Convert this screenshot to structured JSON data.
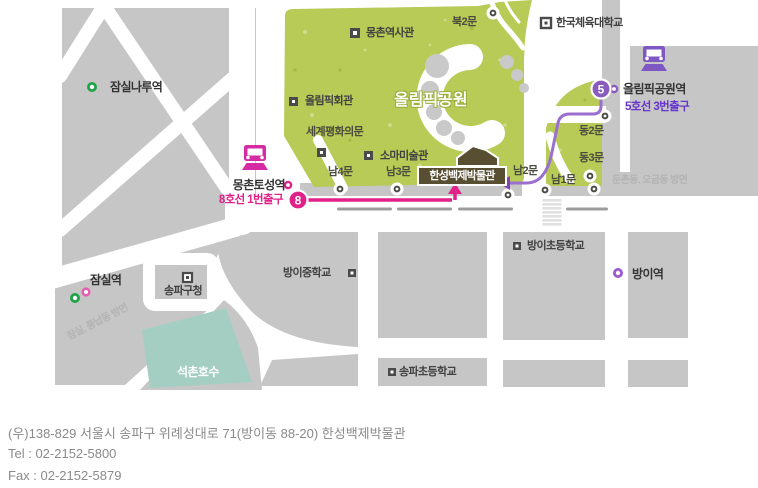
{
  "map": {
    "park": {
      "name": "올림픽공원"
    },
    "places": {
      "mongchon_history_hall": "몽촌역사관",
      "north_gate2": "북2문",
      "korea_national_sport_univ": "한국체육대학교",
      "olympic_hall": "올림픽회관",
      "world_peace_gate": "세계평화의문",
      "soma_museum": "소마미술관",
      "south_gate4": "남4문",
      "south_gate3": "남3문",
      "south_gate2": "남2문",
      "south_gate1": "남1문",
      "east_gate2": "동2문",
      "east_gate3": "동3문",
      "hanseong_baekje_museum": "한성백제박물관",
      "bangi_middle_school": "방이중학교",
      "bangi_elementary_school": "방이초등학교",
      "songpa_elementary_school": "송파초등학교",
      "songpa_gu_office": "송파구청",
      "seokchon_lake": "석촌호수"
    },
    "stations": {
      "jamsilnaru": {
        "name": "잠실나루역"
      },
      "jamsil": {
        "name": "잠실역"
      },
      "bangi": {
        "name": "방이역"
      },
      "mongchontoseong": {
        "name": "몽촌토성역",
        "exit": "8호선 1번출구",
        "line_number": "8"
      },
      "olympic_park": {
        "name": "올림픽공원역",
        "exit": "5호선 3번출구",
        "line_number": "5"
      }
    },
    "directions": {
      "dunchon_ogeum": "둔촌동, 오금동 방면",
      "jamsil_pungnap": "잠실, 풍납동 방면"
    },
    "colors": {
      "line8_magenta": "#e0218a",
      "line5_purple": "#8a5cc0",
      "line5_text": "#6633cc",
      "park_green": "#b8cb57",
      "lake_teal": "#a5cec2",
      "block_gray": "#c6c6c6",
      "museum_brown": "#584e32",
      "station_green": "#1ea348"
    }
  },
  "footer": {
    "address": "(우)138-829 서울시 송파구 위례성대로 71(방이동 88-20) 한성백제박물관",
    "tel": "Tel : 02-2152-5800",
    "fax": "Fax : 02-2152-5879"
  }
}
